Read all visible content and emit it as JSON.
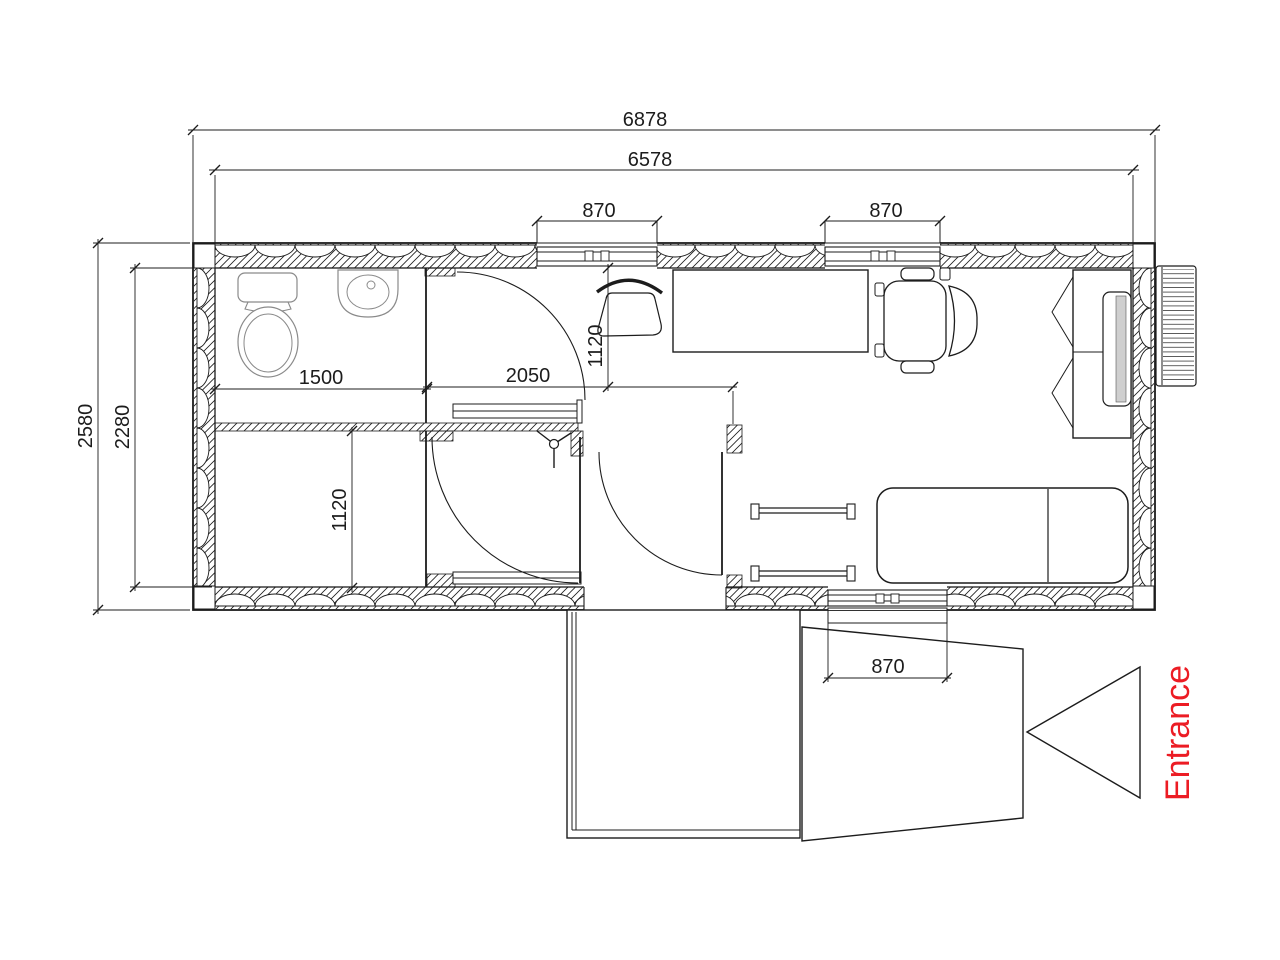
{
  "colors": {
    "ink": "#1c1c1c",
    "entrance_red": "#ec1c24",
    "panel_gray": "#cfcfcf"
  },
  "dimensions": {
    "overall_width": "6878",
    "inner_width": "6578",
    "top_window_left": "870",
    "top_window_right": "870",
    "bathroom_width": "1500",
    "hall_width": "2050",
    "office_bay_depth": "1120",
    "storage_room_depth": "1120",
    "overall_depth": "2580",
    "inner_depth": "2280",
    "bottom_window": "870"
  },
  "annotations": {
    "entrance": "Entrance"
  }
}
